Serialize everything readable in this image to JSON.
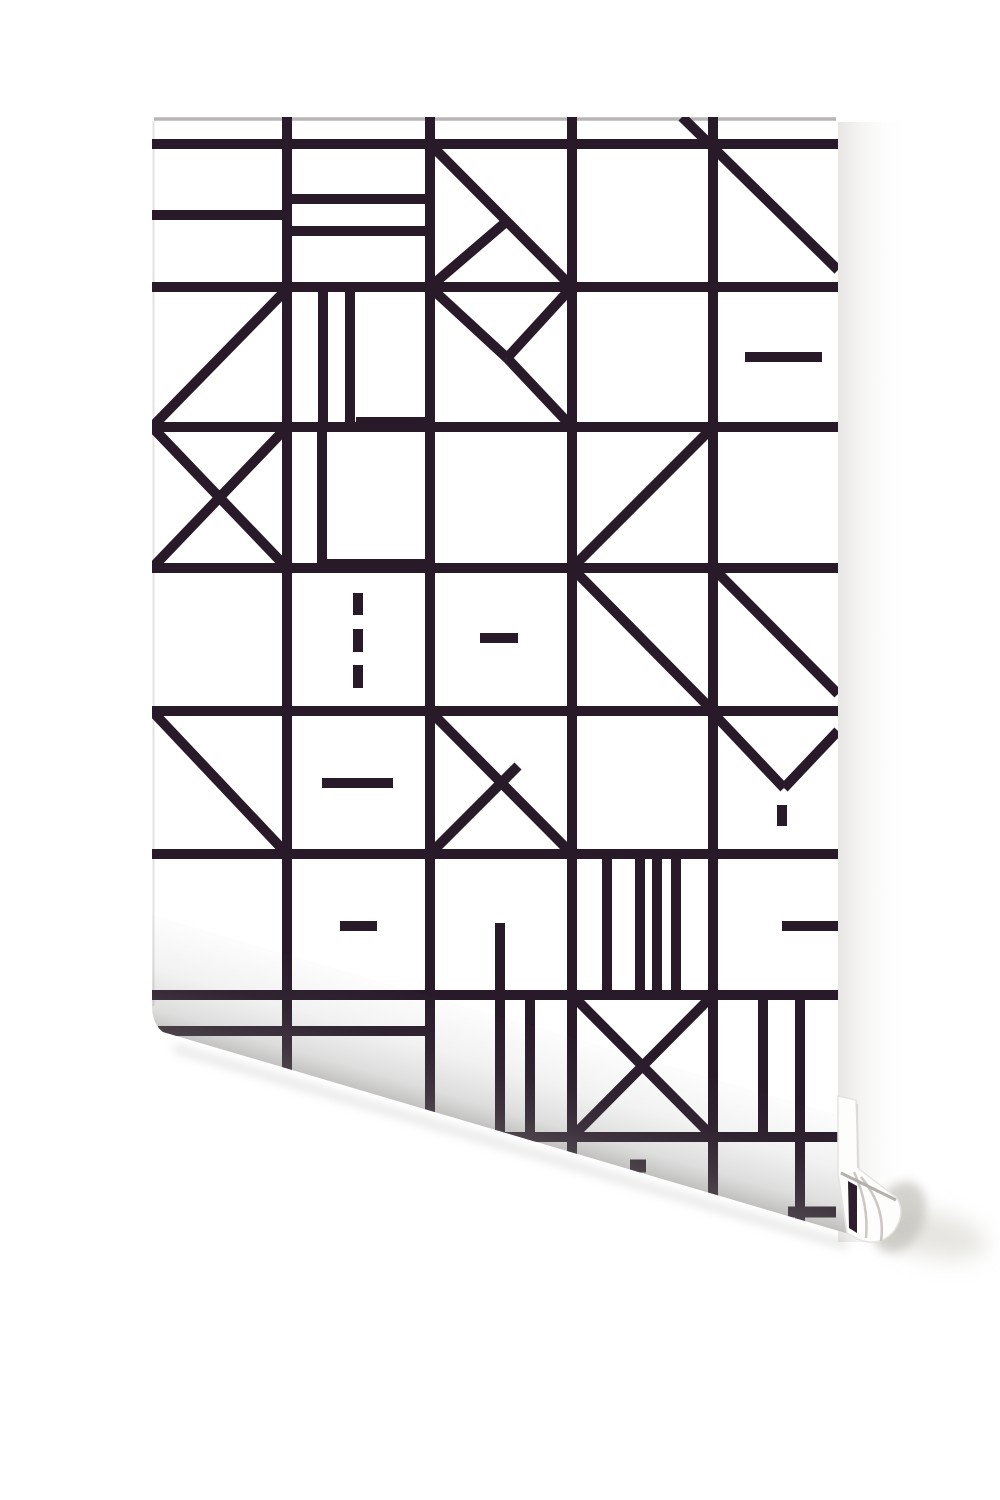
{
  "scene": {
    "width": 1000,
    "height": 1500,
    "background": "#ffffff",
    "subject": "white wallpaper roll with dark geometric line pattern, bottom-left corner curled, rolled tube end at bottom right"
  },
  "palette": {
    "line": "#281a29",
    "paper": "#ffffff",
    "paper_top_edge": "#b2adb0",
    "paper_left_edge": "#e4e2e2",
    "curl_shadow": "#8f8d88",
    "roll_stripe": "#2c1e2c",
    "roll_arc": "#cbc8c4",
    "roll_top_line": "#b4b0ac",
    "roll_edge_line": "#dcdad6",
    "roll_shadow_front": "#c2c0ba",
    "roll_shadow_back": "#dcdad4",
    "wedge_fill": "#fdfdfc",
    "wedge_edge": "#e6e4e0"
  },
  "sheet": {
    "outline": "M152 132 Q152 117 168 117 L822 117 Q838 117 838 132 L838 1166 Q840 1205 849 1234 L163 1032 Q152 1024 152 1006 Z",
    "top_edge": [
      154,
      119,
      836,
      119
    ],
    "left_edge": [
      153.5,
      121,
      153.5,
      1006
    ]
  },
  "grid": {
    "h_y": [
      144,
      287,
      427,
      568,
      711,
      854,
      995,
      1137
    ],
    "v_x": [
      287,
      430,
      572,
      713
    ],
    "h_x1": 152,
    "h_x2": 838,
    "v_y1": 117,
    "v_y2": 1250,
    "stroke": 10
  },
  "motifs": [
    [
      152,
      215,
      287,
      215
    ],
    [
      287,
      199,
      430,
      199
    ],
    [
      287,
      231,
      430,
      231
    ],
    [
      430,
      144,
      572,
      287
    ],
    [
      430,
      287,
      507,
      221
    ],
    [
      682,
      117,
      838,
      270
    ],
    [
      152,
      427,
      287,
      289
    ],
    [
      323,
      287,
      323,
      427
    ],
    [
      350,
      287,
      350,
      427
    ],
    [
      356,
      422,
      430,
      422
    ],
    [
      430,
      287,
      507,
      358
    ],
    [
      572,
      287,
      507,
      358
    ],
    [
      572,
      427,
      507,
      358
    ],
    [
      745,
      357,
      822,
      357
    ],
    [
      152,
      427,
      287,
      568
    ],
    [
      287,
      427,
      152,
      568
    ],
    [
      322,
      427,
      322,
      568
    ],
    [
      324,
      564,
      430,
      564
    ],
    [
      572,
      568,
      713,
      427
    ],
    [
      358,
      593,
      358,
      615
    ],
    [
      358,
      629,
      358,
      652
    ],
    [
      358,
      665,
      358,
      688
    ],
    [
      480,
      638,
      518,
      638
    ],
    [
      572,
      568,
      713,
      711
    ],
    [
      713,
      568,
      838,
      694
    ],
    [
      152,
      711,
      287,
      854
    ],
    [
      322,
      783,
      393,
      783
    ],
    [
      430,
      711,
      572,
      854
    ],
    [
      430,
      854,
      518,
      766
    ],
    [
      713,
      713,
      784,
      788
    ],
    [
      784,
      788,
      838,
      731
    ],
    [
      782,
      805,
      782,
      826
    ],
    [
      340,
      926,
      377,
      926
    ],
    [
      500,
      923,
      500,
      1135
    ],
    [
      607,
      854,
      607,
      995
    ],
    [
      640,
      854,
      640,
      995
    ],
    [
      657,
      854,
      657,
      995
    ],
    [
      676,
      854,
      676,
      995
    ],
    [
      782,
      926,
      838,
      926
    ],
    [
      158,
      1031,
      430,
      1031
    ],
    [
      530,
      995,
      530,
      1142
    ],
    [
      572,
      995,
      713,
      1137
    ],
    [
      713,
      995,
      572,
      1137
    ],
    [
      763,
      995,
      763,
      1137
    ],
    [
      800,
      995,
      800,
      1222
    ],
    [
      630,
      1166,
      646,
      1166,
      13
    ],
    [
      788,
      1212,
      836,
      1212,
      11
    ]
  ],
  "curl": {
    "overlay": "M152 915 L838 1115 L852 1242 L152 1042 Z",
    "grad": {
      "x1": 537,
      "y1": 1016,
      "x2": 503,
      "y2": 1133,
      "stops": [
        [
          0,
          "rgba(128,126,124,0)"
        ],
        [
          0.5,
          "rgba(128,126,124,0.10)"
        ],
        [
          0.82,
          "rgba(128,126,124,0.26)"
        ],
        [
          1,
          "rgba(118,116,114,0.45)"
        ]
      ]
    },
    "shadow_line": [
      174,
      1048,
      848,
      1246
    ]
  },
  "roll": {
    "band": {
      "x": 838,
      "y": 122,
      "w": 74,
      "h": 1120,
      "stops": [
        [
          0,
          "rgba(198,195,190,0.42)"
        ],
        [
          0.45,
          "rgba(226,224,220,0.20)"
        ],
        [
          1,
          "rgba(255,255,255,0)"
        ]
      ]
    },
    "shadow_back": {
      "cx": 930,
      "cy": 1234,
      "rx": 58,
      "ry": 22,
      "rot": 12,
      "opacity": 0.7
    },
    "shadow_front": {
      "cx": 899,
      "cy": 1217,
      "rx": 25,
      "ry": 37,
      "rot": 22,
      "opacity": 0.7
    },
    "wedge": "M838 1096 L856 1100 L859 1169 L897 1198 Q906 1214 894 1231 Q880 1247 860 1240 L847 1233 L838 1174 Z",
    "edge_line": [
      857,
      1104,
      858,
      1168
    ],
    "arcs": [
      "M861 1177 Q886 1207 881 1241",
      "M854 1172 Q869 1204 866 1238"
    ],
    "top_line": [
      841,
      1173,
      896,
      1200
    ],
    "stripe": "M848 1181 L857 1186 L857 1233 L849 1228 Z"
  }
}
